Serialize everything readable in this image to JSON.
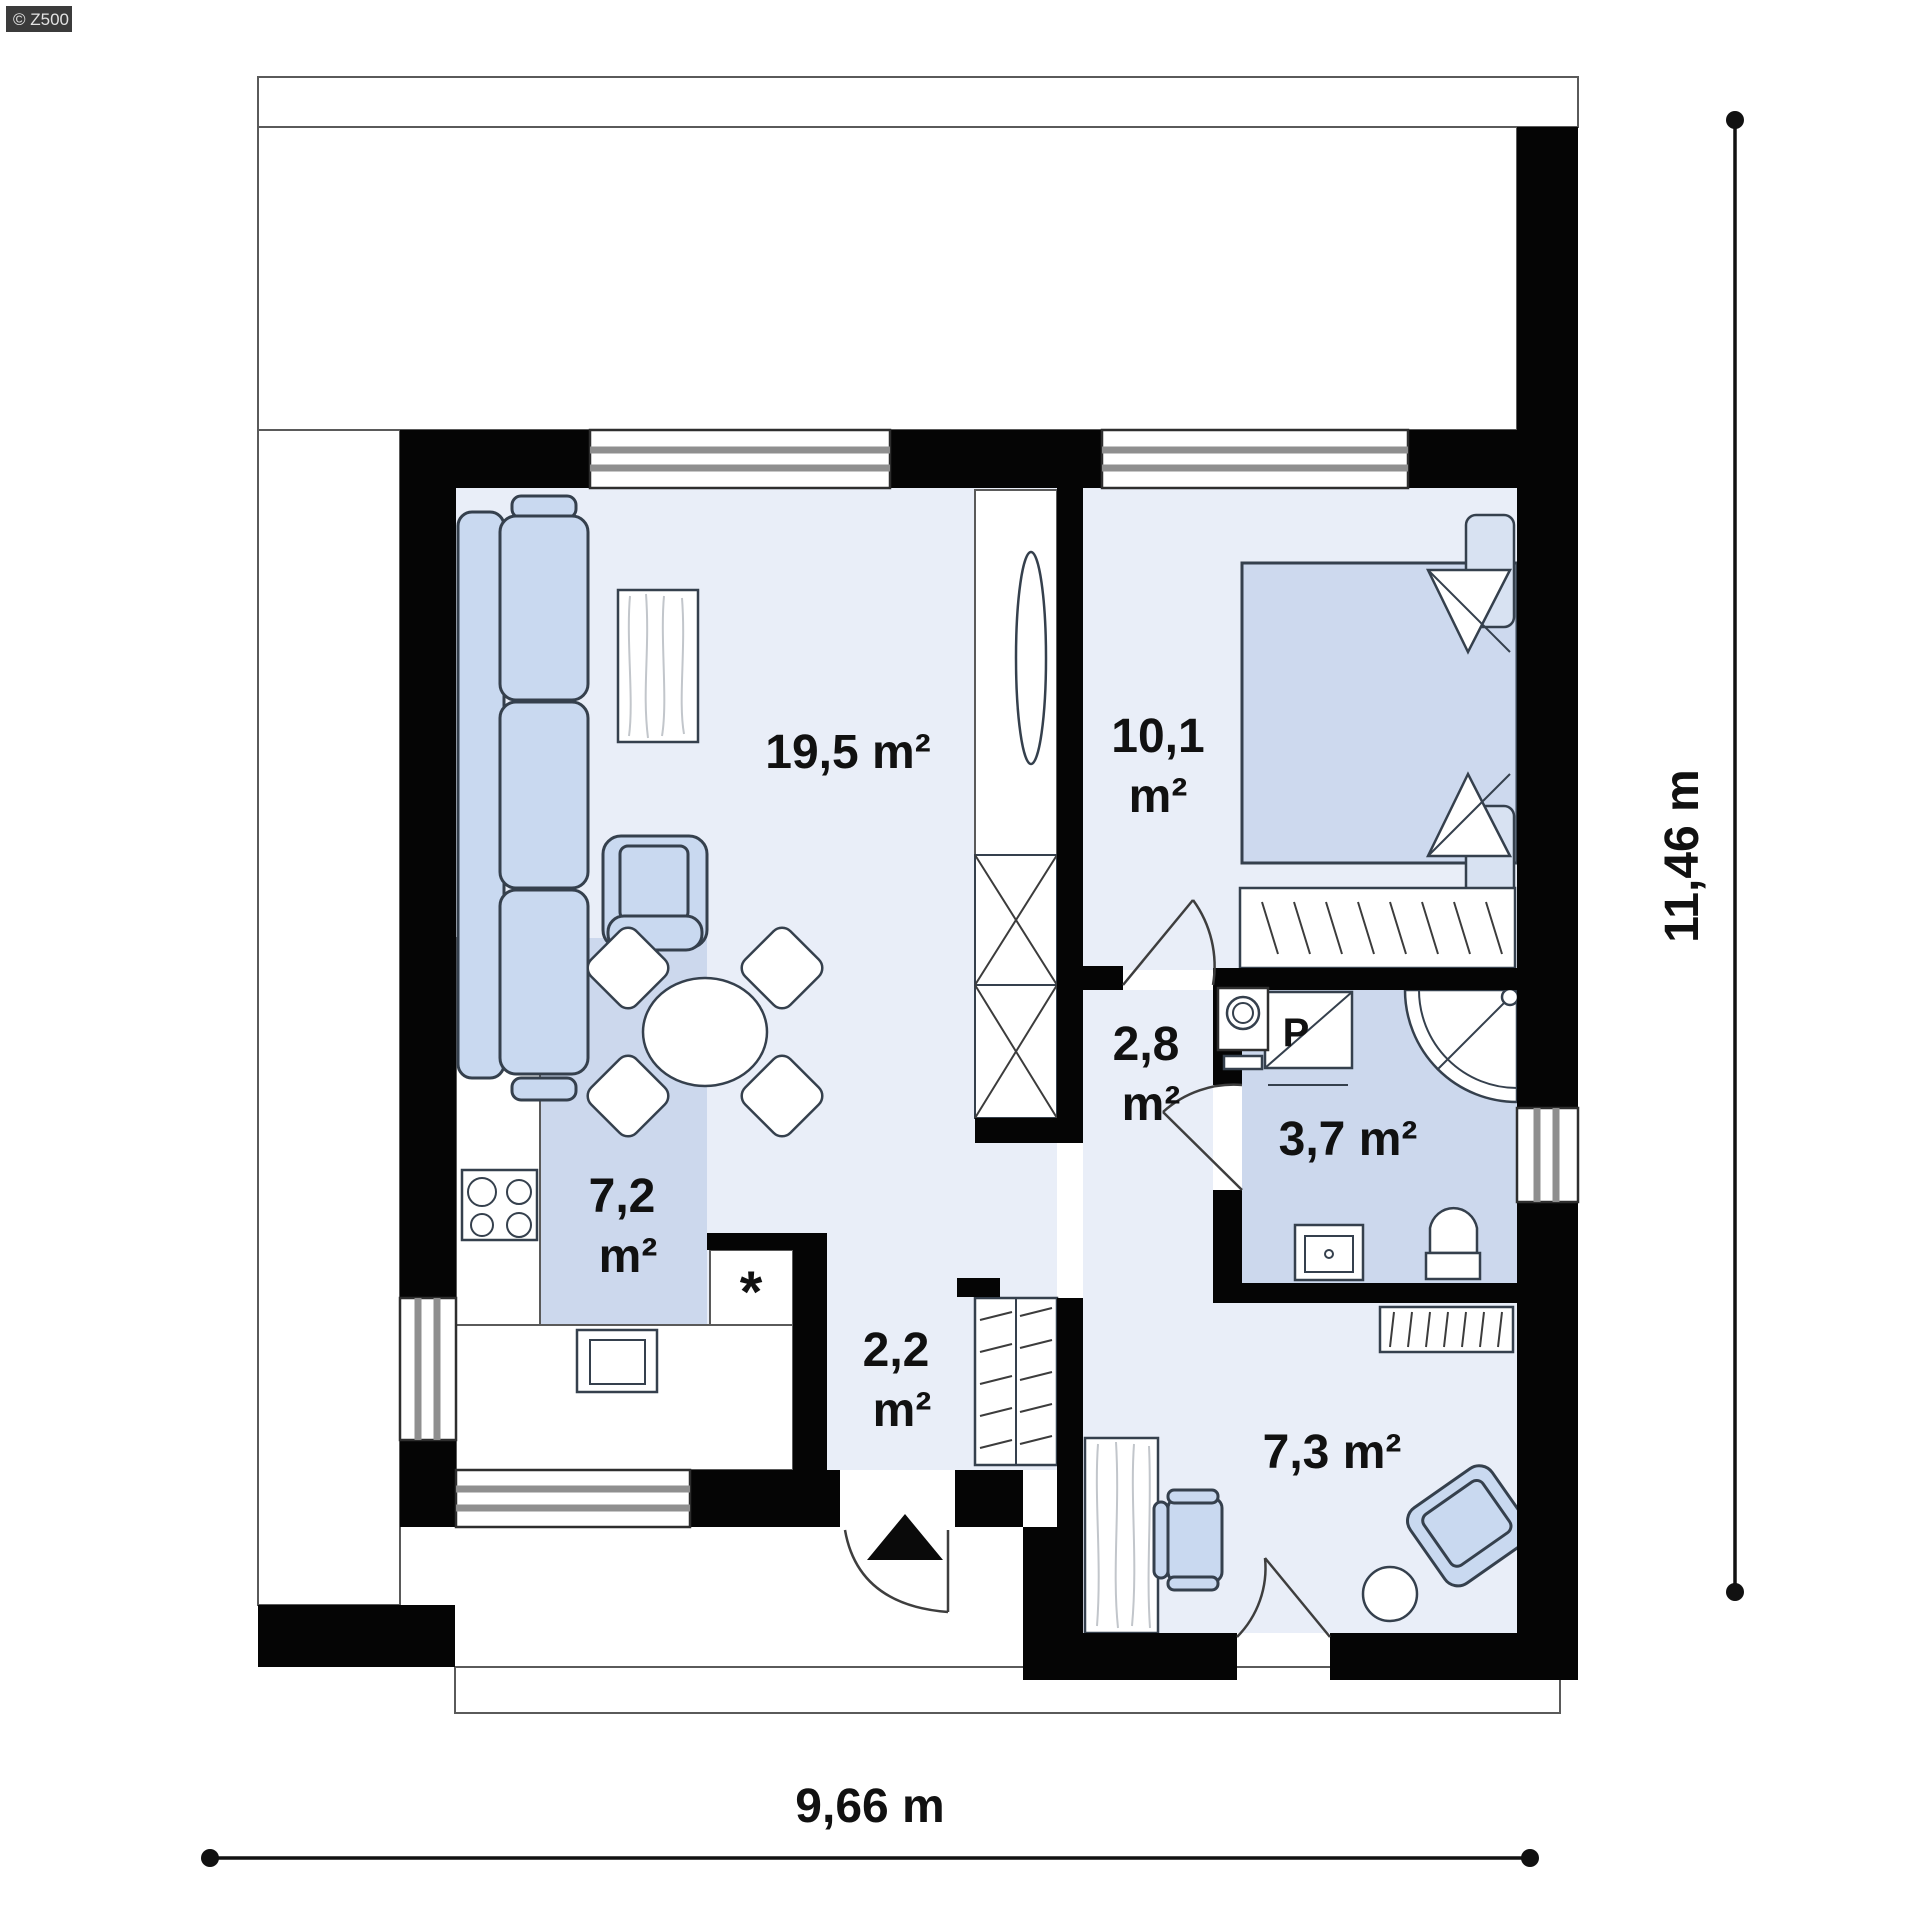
{
  "branding": {
    "watermark": "© Z500"
  },
  "rooms": {
    "living": {
      "name": "living-dining-room",
      "label": "19,5 m²"
    },
    "bedroom": {
      "name": "bedroom",
      "line1": "10,1",
      "line2": "m²"
    },
    "hall": {
      "name": "hall",
      "line1": "2,8",
      "line2": "m²"
    },
    "bathroom": {
      "name": "bathroom",
      "label": "3,7 m²"
    },
    "kitchen": {
      "name": "kitchen",
      "line1": "7,2",
      "line2": "m²"
    },
    "entry": {
      "name": "entry-vestibule",
      "line1": "2,2",
      "line2": "m²"
    },
    "office": {
      "name": "office-room",
      "label": "7,3 m²"
    }
  },
  "fixtures": {
    "washing_machine_label": "P",
    "appliance_marker": "*"
  },
  "dimensions": {
    "width": {
      "label": "9,66 m"
    },
    "height": {
      "label": "11,46 m"
    }
  },
  "colors": {
    "wall": "#050505",
    "floorLight": "#e9eef8",
    "floorBlue": "#ccd8ed",
    "furnBlue": "#c9d9f0",
    "furnStroke": "#35404d",
    "line": "#5a5a5a",
    "winStripe": "#8f8f8f",
    "text": "#111111",
    "badgeBg": "#3b3b3b",
    "badgeText": "#e3e3e3"
  }
}
